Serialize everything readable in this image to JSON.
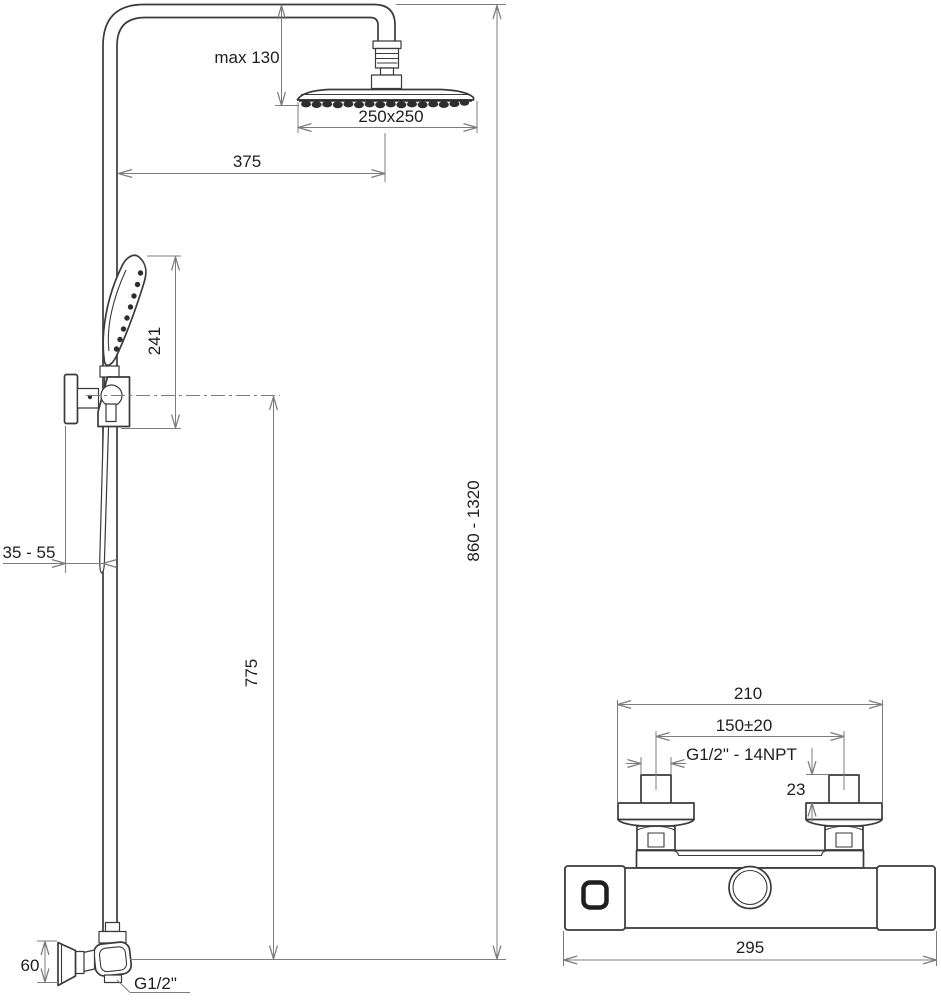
{
  "figure": {
    "kind": "technical dimensional drawing",
    "subject": "shower column with overhead shower, hand shower and wall-mounted thermostatic mixer",
    "units": "mm"
  },
  "colors": {
    "bg": "#ffffff",
    "outline": "#3a3a3a",
    "dimension": "#7d7d7d",
    "darkfill": "#2e2e2e",
    "text": "#1e1e1e"
  },
  "shower_column": {
    "labels": {
      "max_head_drop": "max 130",
      "head_size": "250x250",
      "reach": "375",
      "hand_shower_length": "241",
      "height_range": "860 - 1320",
      "hose_outlet_height": "775",
      "wall_clearance": "35 - 55",
      "elbow": "60",
      "thread": "G1/2\""
    }
  },
  "mixer": {
    "labels": {
      "mount_span": "210",
      "inlet_spacing": "150±20",
      "thread": "G1/2\" - 14NPT",
      "stub_height": "23",
      "body_width": "295"
    }
  }
}
